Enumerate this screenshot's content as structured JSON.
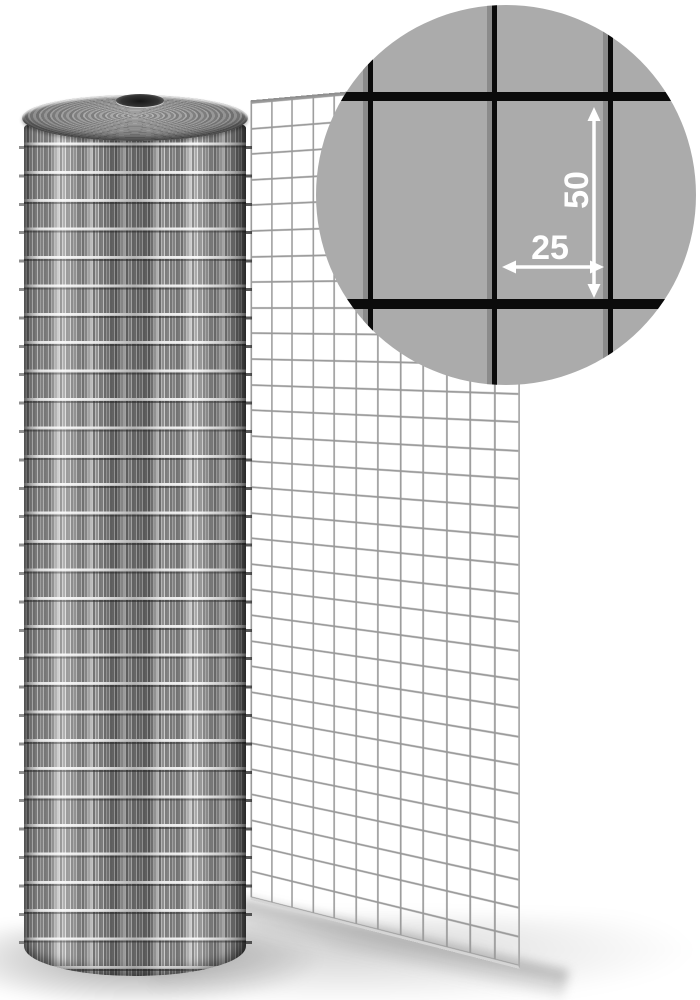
{
  "magnifier": {
    "dimension_vertical_label": "50",
    "dimension_horizontal_label": "25"
  },
  "colors": {
    "magnifier_background": "#ABABAB",
    "magnifier_wire_black": "#0B0B0B",
    "magnifier_wire_shadow_gray": "#8B8B8B",
    "sheet_wire_gray": "#999999",
    "annotation_white": "#FFFFFF",
    "page_background": "#FFFFFF"
  }
}
